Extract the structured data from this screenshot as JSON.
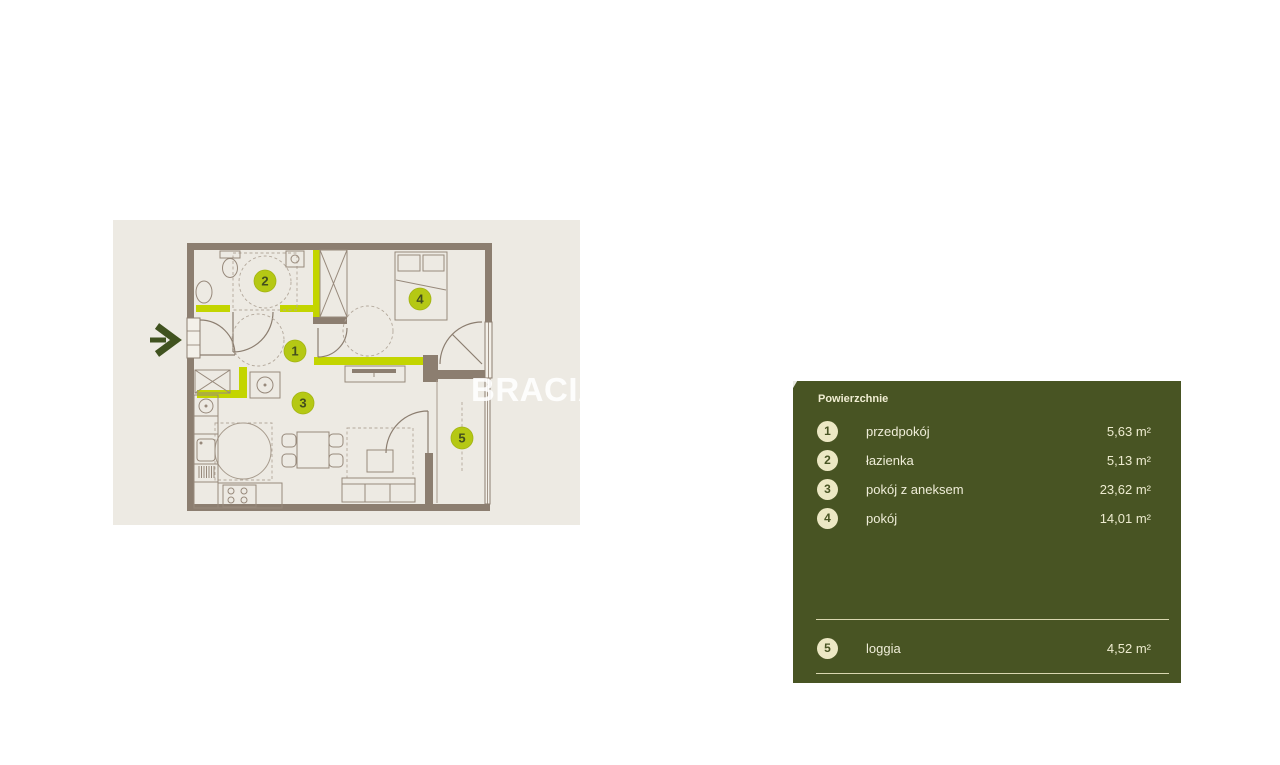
{
  "page": {
    "background": "#FFFFFF"
  },
  "floor_plan": {
    "background": "#EDEAE3",
    "wall_color": "#8C7E70",
    "accent_wall_color": "#C3D500",
    "marker_fill": "#B5C814",
    "marker_text_color": "#434E1E",
    "entry_arrow_color": "#40521F",
    "room_markers": [
      "1",
      "2",
      "3",
      "4",
      "5"
    ]
  },
  "watermark": {
    "text": "BRACIA SADURSCY",
    "color": "#FFFFFF"
  },
  "legend": {
    "title": "Powierzchnie",
    "background": "#485423",
    "text_color": "#F0EDD2",
    "circle_fill": "#ECE8C4",
    "rows": [
      {
        "num": "1",
        "label": "przedpokój",
        "value": "5,63 m²"
      },
      {
        "num": "2",
        "label": "łazienka",
        "value": "5,13 m²"
      },
      {
        "num": "3",
        "label": "pokój z aneksem",
        "value": "23,62 m²"
      },
      {
        "num": "4",
        "label": "pokój",
        "value": "14,01 m²"
      }
    ],
    "footer_rows": [
      {
        "num": "5",
        "label": "loggia",
        "value": "4,52 m²"
      }
    ]
  }
}
